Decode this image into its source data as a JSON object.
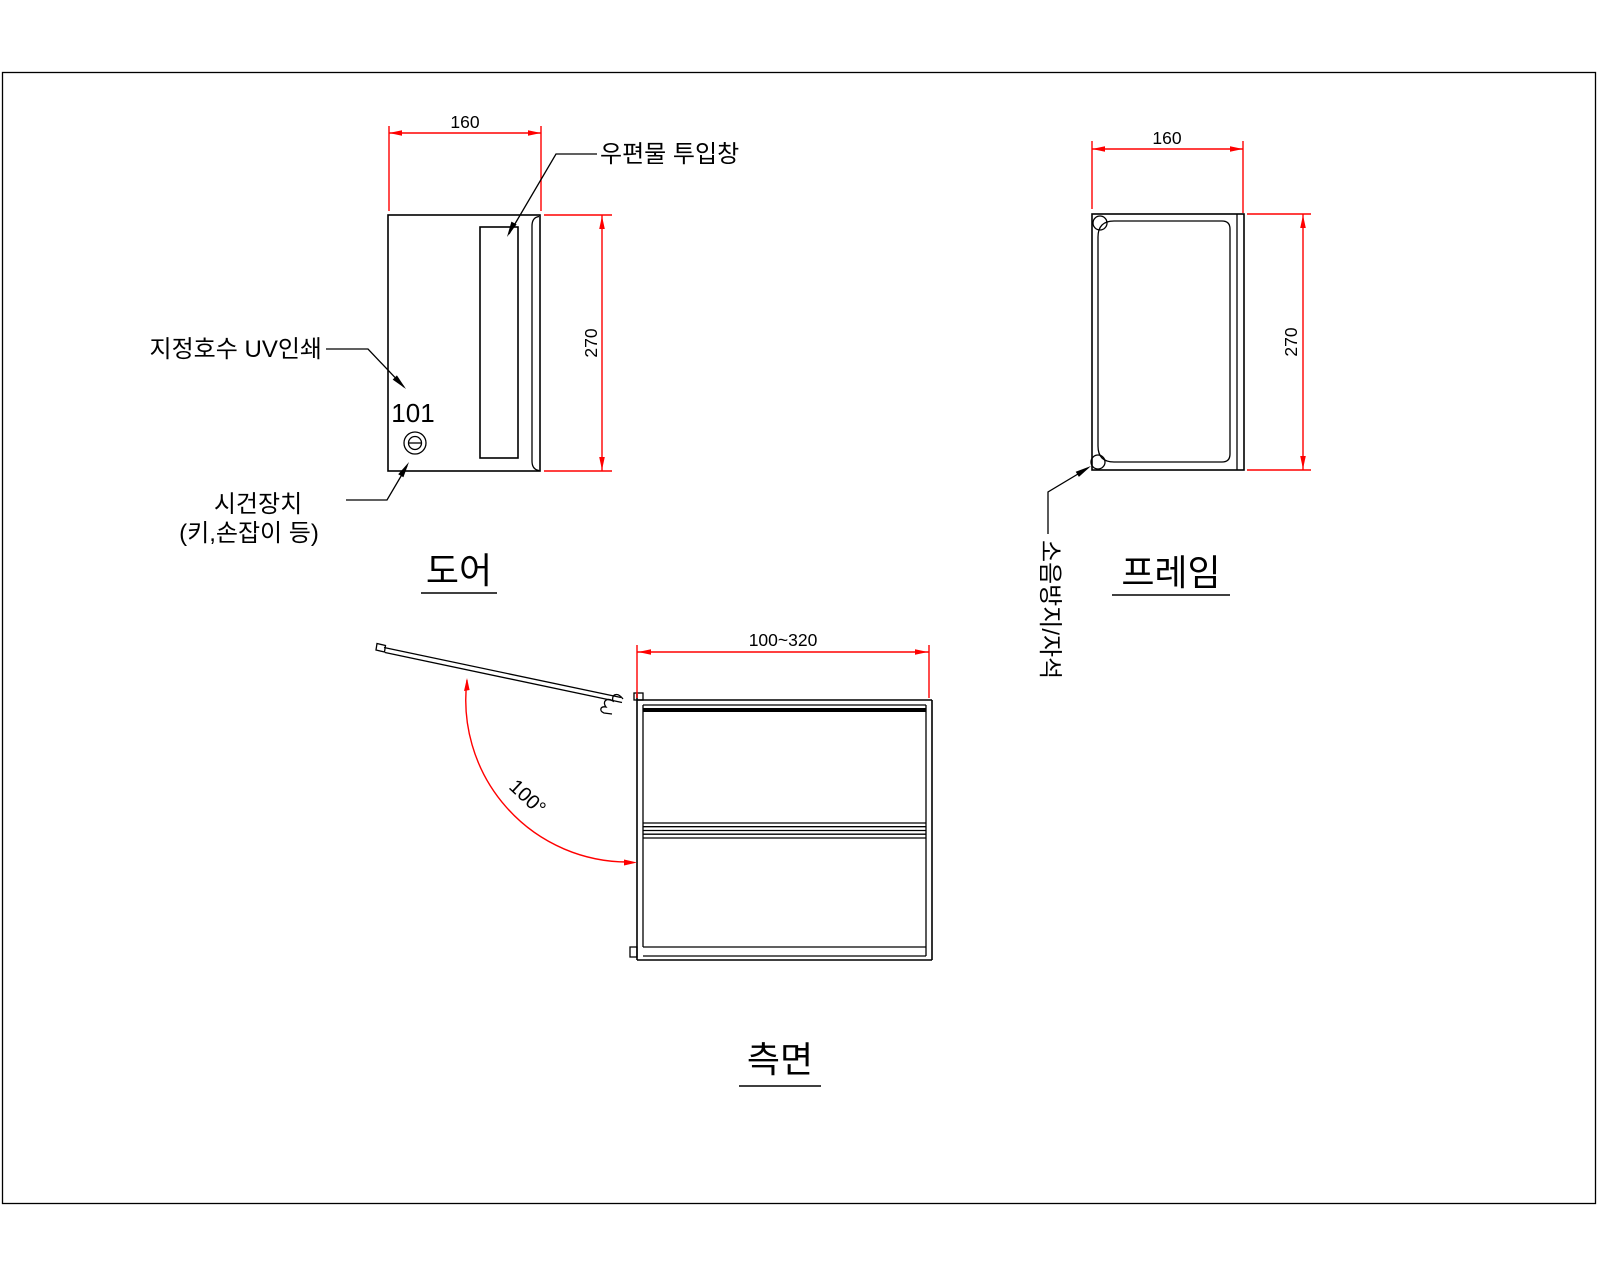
{
  "sheet": {
    "background": "#ffffff",
    "border_color": "#000000"
  },
  "colors": {
    "line": "#000000",
    "dimension": "#ff0000",
    "text": "#000000"
  },
  "views": {
    "door": {
      "title": "도어",
      "width_dim": "160",
      "height_dim": "270",
      "unit_number": "101",
      "mail_slot_label": "우편물 투입창",
      "uv_print_label": "지정호수 UV인쇄",
      "lock_label_line1": "시건장치",
      "lock_label_line2": "(키,손잡이 등)"
    },
    "frame": {
      "title": "프레임",
      "width_dim": "160",
      "height_dim": "270",
      "magnet_label": "소음방지/자석"
    },
    "side": {
      "title": "측면",
      "depth_dim": "100~320",
      "open_angle": "100°"
    }
  }
}
